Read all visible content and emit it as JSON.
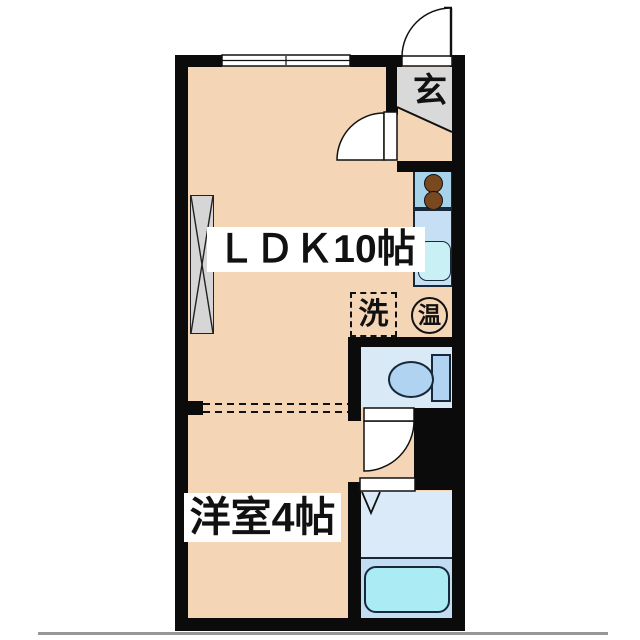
{
  "floorplan": {
    "rooms": {
      "ldk": {
        "label": "ＬＤＫ10帖"
      },
      "western_room": {
        "label": "洋室4帖"
      },
      "entrance": {
        "label": "玄"
      }
    },
    "fixtures": {
      "washing_machine": {
        "label": "洗"
      },
      "water_heater": {
        "label": "温"
      }
    },
    "colors": {
      "floor": "#F4D5B5",
      "wall": "#0B0B0B",
      "entrance_tile": "#D9D9D9",
      "toilet_room": "#D9E9F6",
      "bathroom_upper": "#DBEAF8",
      "bathroom_lower": "#C2DCF3",
      "bathtub": "#ABEBF4",
      "stove_counter": "#A6D3EA",
      "sink_counter": "#C6DFF4",
      "sink_basin": "#C8F0F5",
      "burner": "#7A481E",
      "toilet_fixture": "#AFD3F0",
      "closet": "#D6D6D6",
      "outline": "#16283A",
      "page_divider": "#979797"
    }
  }
}
